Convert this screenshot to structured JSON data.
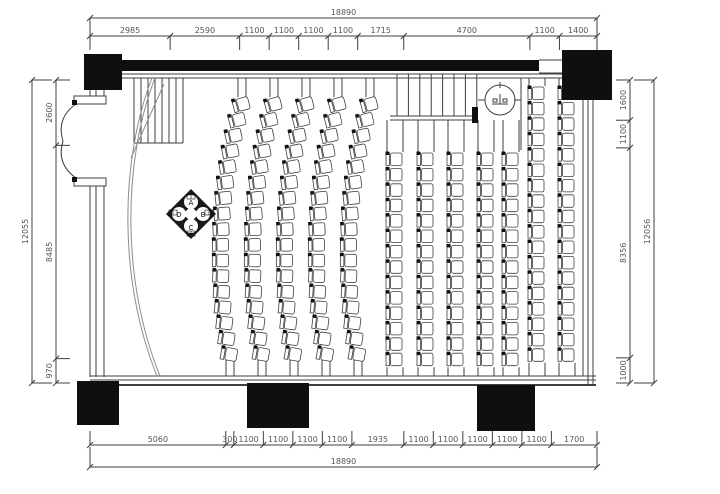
{
  "drawing": {
    "type": "auditorium-seating-floor-plan",
    "units": "mm"
  },
  "colors": {
    "line": "#3f3f3f",
    "wall": "#0f0f0f",
    "dim": "#555555",
    "curve": "#8c8c8c",
    "seat_fill": "#ffffff",
    "background": "#ffffff"
  },
  "dimensions": {
    "top": {
      "total": 18890,
      "segments": [
        2985,
        2590,
        1100,
        1100,
        1100,
        1100,
        1715,
        4700,
        1100,
        1400
      ]
    },
    "bottom": {
      "total": 18890,
      "segments": [
        5060,
        300,
        1100,
        1100,
        1100,
        1100,
        1935,
        1100,
        1100,
        1100,
        1100,
        1100,
        1700
      ]
    },
    "left": {
      "total": 12055,
      "segments": [
        2600,
        8485,
        970
      ]
    },
    "right": {
      "total": 12056,
      "segments": [
        1600,
        1100,
        8356,
        1000
      ]
    }
  },
  "seating": {
    "curved_section": {
      "column_centers": [
        230,
        262,
        294,
        326,
        358
      ],
      "seats_per_column": 17,
      "top_y": 104,
      "bottom_y": 354
    },
    "straight_section": {
      "column_centers": [
        395,
        426,
        456,
        486,
        511,
        537,
        567
      ],
      "short_count": 14,
      "tall_count": 18,
      "tall_from_index": 5,
      "short_top_y": 159,
      "tall_top_y": 93,
      "pitch": 15.4
    }
  },
  "emblem": {
    "letters": [
      "A",
      "B",
      "C",
      "D"
    ]
  },
  "symbols": {
    "fan_symbol": "ceiling-fan-symbol",
    "double_door": "double-swing-door",
    "stairs": "entry-steps",
    "ramp_steps": "side-entry-steps"
  }
}
